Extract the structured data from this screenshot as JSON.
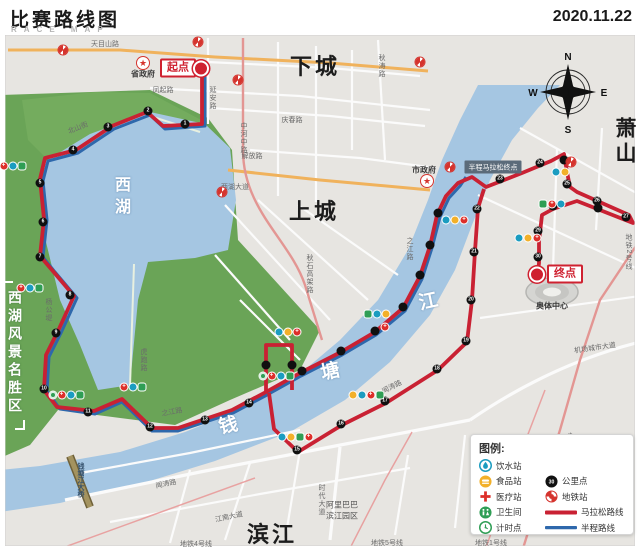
{
  "header": {
    "title": "比赛路线图",
    "subtitle": "RACE MAP",
    "date": "2020.11.22"
  },
  "compass": {
    "n": "N",
    "e": "E",
    "s": "S",
    "w": "W"
  },
  "map": {
    "scenic_area": "西湖风景名胜区",
    "markers": {
      "start_label": "起点",
      "finish_label": "终点",
      "half_finish_label": "半程马拉松终点"
    },
    "labels": [
      {
        "t": "下城",
        "x": 315,
        "y": 65,
        "cls": "d"
      },
      {
        "t": "上城",
        "x": 314,
        "y": 210,
        "cls": "d"
      },
      {
        "t": "滨江",
        "x": 272,
        "y": 533,
        "cls": "d"
      },
      {
        "t": "萧山",
        "x": 624,
        "y": 142,
        "cls": "dv"
      },
      {
        "t": "西湖",
        "x": 120,
        "y": 198,
        "cls": "wv"
      },
      {
        "t": "钱",
        "x": 228,
        "y": 424,
        "cls": "wb",
        "rot": -12
      },
      {
        "t": "塘",
        "x": 330,
        "y": 370,
        "cls": "wb",
        "rot": -12
      },
      {
        "t": "江",
        "x": 428,
        "y": 300,
        "cls": "wb",
        "rot": -12
      },
      {
        "t": "天目山路",
        "x": 105,
        "y": 44,
        "cls": "r"
      },
      {
        "t": "凤起路",
        "x": 163,
        "y": 90,
        "cls": "r"
      },
      {
        "t": "庆春路",
        "x": 292,
        "y": 120,
        "cls": "r"
      },
      {
        "t": "延安路",
        "x": 212,
        "y": 98,
        "cls": "rv"
      },
      {
        "t": "中河中路",
        "x": 243,
        "y": 138,
        "cls": "rv"
      },
      {
        "t": "秋涛路",
        "x": 381,
        "y": 66,
        "cls": "rv"
      },
      {
        "t": "解放路",
        "x": 252,
        "y": 156,
        "cls": "r"
      },
      {
        "t": "西湖大道",
        "x": 235,
        "y": 187,
        "cls": "r"
      },
      {
        "t": "秋石高架路",
        "x": 309,
        "y": 274,
        "cls": "rv"
      },
      {
        "t": "北山街",
        "x": 78,
        "y": 128,
        "cls": "r",
        "rot": -22
      },
      {
        "t": "杨公堤",
        "x": 48,
        "y": 310,
        "cls": "rv"
      },
      {
        "t": "虎跑路",
        "x": 143,
        "y": 360,
        "cls": "rv"
      },
      {
        "t": "之江路",
        "x": 172,
        "y": 412,
        "cls": "r",
        "rot": -10
      },
      {
        "t": "之江路",
        "x": 409,
        "y": 249,
        "cls": "rv"
      },
      {
        "t": "闻涛路",
        "x": 166,
        "y": 484,
        "cls": "r",
        "rot": -12
      },
      {
        "t": "闻涛路",
        "x": 392,
        "y": 387,
        "cls": "r",
        "rot": -27
      },
      {
        "t": "江南大道",
        "x": 229,
        "y": 517,
        "cls": "r",
        "rot": -12
      },
      {
        "t": "江南大道",
        "x": 560,
        "y": 440,
        "cls": "r",
        "rot": -18
      },
      {
        "t": "时代大道",
        "x": 321,
        "y": 500,
        "cls": "rv"
      },
      {
        "t": "机场城市大道",
        "x": 595,
        "y": 348,
        "cls": "r",
        "rot": -8
      },
      {
        "t": "地铁4号线",
        "x": 196,
        "y": 544,
        "cls": "r"
      },
      {
        "t": "地铁5号线",
        "x": 387,
        "y": 543,
        "cls": "r"
      },
      {
        "t": "地铁1号线",
        "x": 491,
        "y": 543,
        "cls": "r"
      },
      {
        "t": "地铁2号线",
        "x": 628,
        "y": 252,
        "cls": "rv"
      },
      {
        "t": "钱塘江大桥",
        "x": 80,
        "y": 480,
        "cls": "bv"
      },
      {
        "t": "省政府",
        "x": 143,
        "y": 74,
        "cls": "p"
      },
      {
        "t": "市政府",
        "x": 424,
        "y": 170,
        "cls": "p"
      },
      {
        "t": "奥体中心",
        "x": 552,
        "y": 306,
        "cls": "p"
      },
      {
        "t": "阿里巴巴",
        "x": 342,
        "y": 505,
        "cls": "p2"
      },
      {
        "t": "滨江园区",
        "x": 342,
        "y": 516,
        "cls": "p2"
      }
    ],
    "km_points": [
      {
        "x": 185,
        "y": 124,
        "n": "1"
      },
      {
        "x": 148,
        "y": 111,
        "n": "2"
      },
      {
        "x": 108,
        "y": 127,
        "n": "3"
      },
      {
        "x": 73,
        "y": 150,
        "n": "4"
      },
      {
        "x": 40,
        "y": 183,
        "n": "5"
      },
      {
        "x": 43,
        "y": 222,
        "n": "6"
      },
      {
        "x": 40,
        "y": 257,
        "n": "7"
      },
      {
        "x": 70,
        "y": 295,
        "n": "8"
      },
      {
        "x": 56,
        "y": 333,
        "n": "9"
      },
      {
        "x": 44,
        "y": 389,
        "n": "10"
      },
      {
        "x": 88,
        "y": 412,
        "n": "11"
      },
      {
        "x": 150,
        "y": 427,
        "n": "12"
      },
      {
        "x": 205,
        "y": 420,
        "n": "13"
      },
      {
        "x": 249,
        "y": 403,
        "n": "14"
      },
      {
        "x": 302,
        "y": 371,
        "n": ""
      },
      {
        "x": 341,
        "y": 351,
        "n": ""
      },
      {
        "x": 375,
        "y": 331,
        "n": ""
      },
      {
        "x": 403,
        "y": 307,
        "n": ""
      },
      {
        "x": 420,
        "y": 275,
        "n": ""
      },
      {
        "x": 430,
        "y": 245,
        "n": ""
      },
      {
        "x": 438,
        "y": 213,
        "n": ""
      },
      {
        "x": 297,
        "y": 450,
        "n": "15"
      },
      {
        "x": 341,
        "y": 424,
        "n": "16"
      },
      {
        "x": 385,
        "y": 401,
        "n": "17"
      },
      {
        "x": 437,
        "y": 369,
        "n": "18"
      },
      {
        "x": 466,
        "y": 341,
        "n": "19"
      },
      {
        "x": 471,
        "y": 300,
        "n": "20"
      },
      {
        "x": 474,
        "y": 252,
        "n": "21"
      },
      {
        "x": 477,
        "y": 209,
        "n": "22"
      },
      {
        "x": 500,
        "y": 179,
        "n": "23"
      },
      {
        "x": 540,
        "y": 163,
        "n": "24"
      },
      {
        "x": 564,
        "y": 160,
        "n": ""
      },
      {
        "x": 567,
        "y": 184,
        "n": "25"
      },
      {
        "x": 597,
        "y": 201,
        "n": "26"
      },
      {
        "x": 626,
        "y": 217,
        "n": "27"
      },
      {
        "x": 598,
        "y": 208,
        "n": ""
      },
      {
        "x": 553,
        "y": 206,
        "n": "28"
      },
      {
        "x": 538,
        "y": 231,
        "n": "29"
      },
      {
        "x": 538,
        "y": 257,
        "n": "30"
      },
      {
        "x": 266,
        "y": 365,
        "n": ""
      },
      {
        "x": 292,
        "y": 365,
        "n": ""
      }
    ],
    "stations": [
      {
        "x": 8,
        "y": 166,
        "icons": [
          "timing",
          "medical",
          "water",
          "toilet"
        ]
      },
      {
        "x": 30,
        "y": 288,
        "icons": [
          "medical",
          "water",
          "toilet"
        ]
      },
      {
        "x": 66,
        "y": 395,
        "icons": [
          "timing",
          "medical",
          "water",
          "toilet"
        ]
      },
      {
        "x": 133,
        "y": 387,
        "icons": [
          "medical",
          "water",
          "toilet"
        ]
      },
      {
        "x": 276,
        "y": 376,
        "icons": [
          "timing",
          "medical",
          "water",
          "toilet"
        ]
      },
      {
        "x": 288,
        "y": 332,
        "icons": [
          "water",
          "food",
          "medical"
        ]
      },
      {
        "x": 377,
        "y": 314,
        "icons": [
          "toilet",
          "water",
          "food"
        ]
      },
      {
        "x": 385,
        "y": 327,
        "icons": [
          "medical"
        ]
      },
      {
        "x": 366,
        "y": 395,
        "icons": [
          "food",
          "water",
          "medical",
          "toilet"
        ]
      },
      {
        "x": 295,
        "y": 437,
        "icons": [
          "water",
          "food",
          "toilet",
          "medical"
        ]
      },
      {
        "x": 455,
        "y": 220,
        "icons": [
          "water",
          "food",
          "medical"
        ]
      },
      {
        "x": 560,
        "y": 172,
        "icons": [
          "water",
          "food"
        ]
      },
      {
        "x": 552,
        "y": 204,
        "icons": [
          "toilet",
          "medical",
          "water"
        ]
      },
      {
        "x": 528,
        "y": 238,
        "icons": [
          "water",
          "food",
          "medical"
        ]
      }
    ],
    "metro_icons": [
      {
        "x": 63,
        "y": 50
      },
      {
        "x": 198,
        "y": 42
      },
      {
        "x": 238,
        "y": 80
      },
      {
        "x": 420,
        "y": 62
      },
      {
        "x": 450,
        "y": 167
      },
      {
        "x": 222,
        "y": 192
      },
      {
        "x": 571,
        "y": 162
      }
    ],
    "gov_stars": [
      {
        "x": 143,
        "y": 63
      },
      {
        "x": 427,
        "y": 181
      }
    ]
  },
  "legend": {
    "title": "图例:",
    "km_sample": "30",
    "left": [
      {
        "type": "water",
        "label": "饮水站"
      },
      {
        "type": "food",
        "label": "食品站"
      },
      {
        "type": "medical",
        "label": "医疗站"
      },
      {
        "type": "toilet",
        "label": "卫生间"
      },
      {
        "type": "timing",
        "label": "计时点"
      }
    ],
    "right": [
      {
        "type": "km",
        "label": "公里点"
      },
      {
        "type": "metro",
        "label": "地铁站"
      },
      {
        "type": "route-full",
        "label": "马拉松路线"
      },
      {
        "type": "route-half",
        "label": "半程路线"
      }
    ]
  },
  "colors": {
    "route_full": "#c92133",
    "route_half": "#2e68ac",
    "water": "#a5c6e2",
    "park": "#6aa457",
    "accent_red": "#cf2130"
  }
}
